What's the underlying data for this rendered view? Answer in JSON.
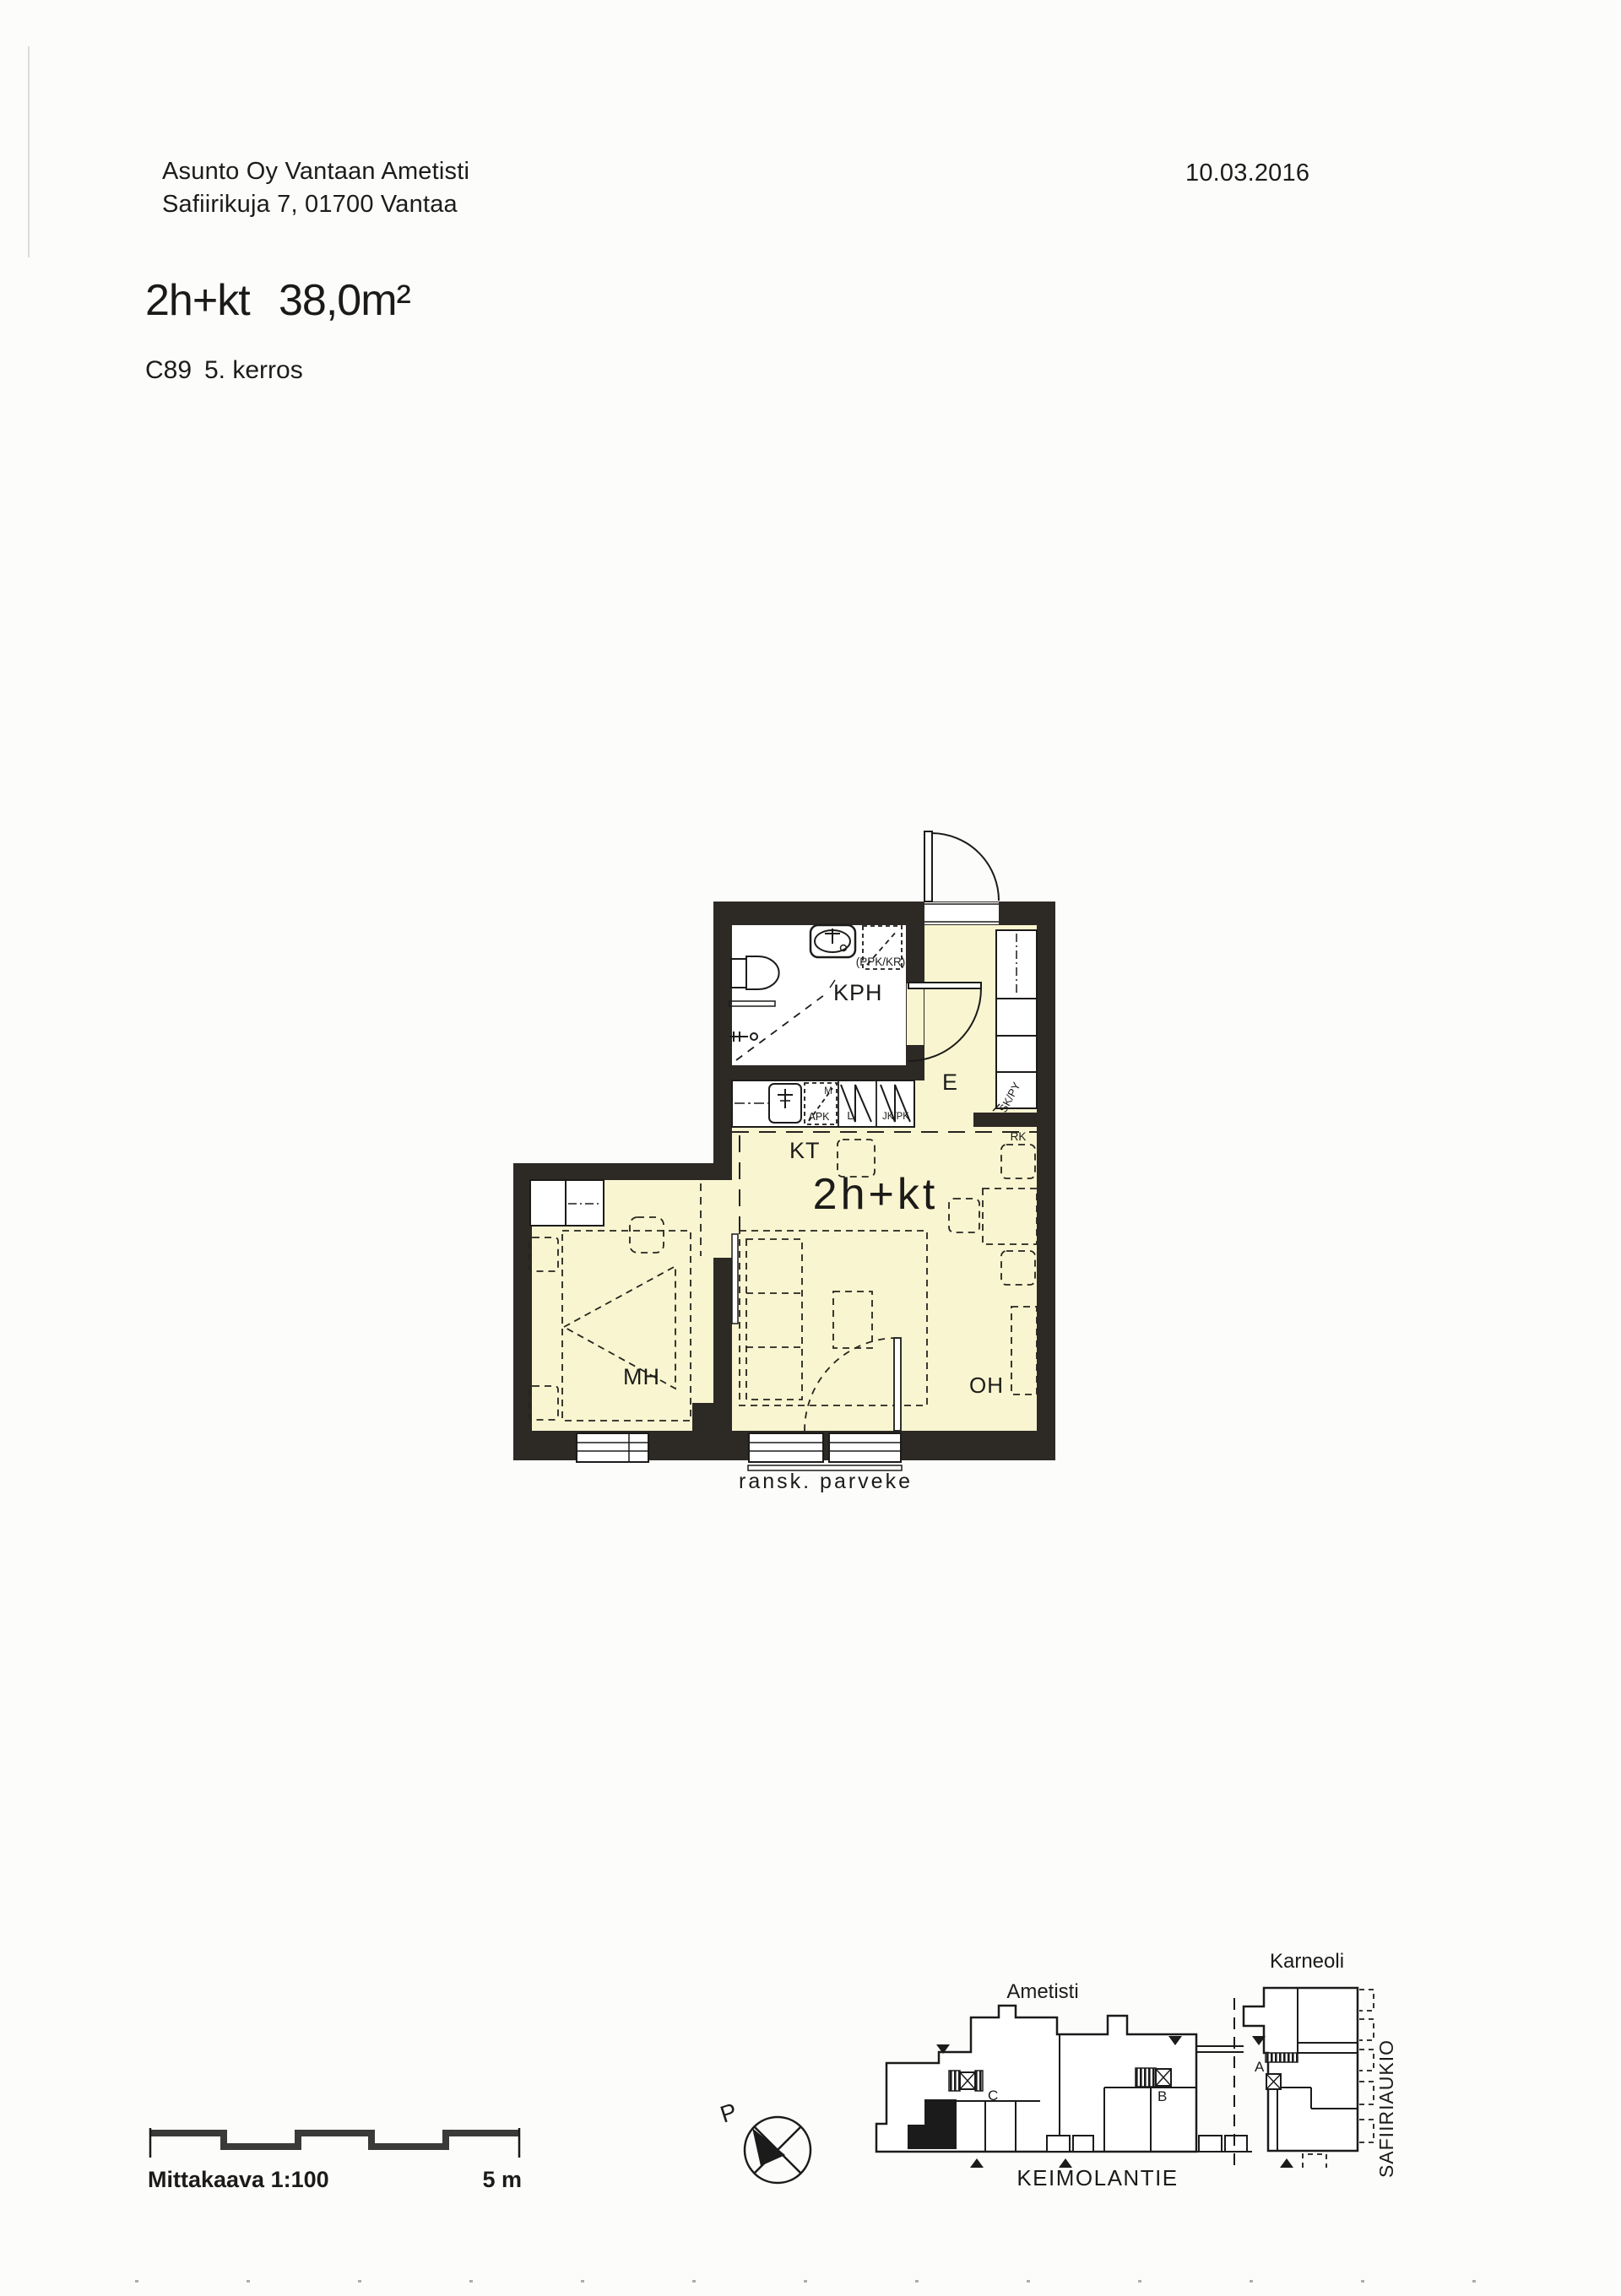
{
  "header": {
    "building": "Asunto Oy Vantaan Ametisti",
    "address": "Safiirikuja 7, 01700 Vantaa",
    "date": "10.03.2016",
    "apartment_type": "2h+kt",
    "area": "38,0m²",
    "apartment_number": "C89",
    "floor": "5. kerros"
  },
  "floor_plan": {
    "unit_label": "2h+kt",
    "rooms": {
      "bathroom": "KPH",
      "kitchen": "KT",
      "entry": "E",
      "bedroom": "MH",
      "living_room": "OH"
    },
    "markings": {
      "washer_dryer_reservation": "(PPK/KR)",
      "dishwasher": "APK",
      "microwave": "M",
      "stove": "L",
      "fridge_freezer": "JK/PK",
      "closet": "SK/PY",
      "distribution_board": "RK",
      "french_balcony": "ransk. parveke"
    }
  },
  "footer": {
    "scale_label": "Mittakaava 1:100",
    "scale_end": "5 m",
    "north_label": "P"
  },
  "site_plan": {
    "buildings": {
      "ametisti": "Ametisti",
      "karneoli": "Karneoli"
    },
    "street": "KEIMOLANTIE",
    "square": "SAFIIRIAUKIO",
    "stairwells": {
      "a": "A",
      "b": "B",
      "c": "C"
    }
  },
  "colors": {
    "floor_fill": "#f8f5d0",
    "wall": "#2d2925",
    "ink": "#1c1b19"
  }
}
